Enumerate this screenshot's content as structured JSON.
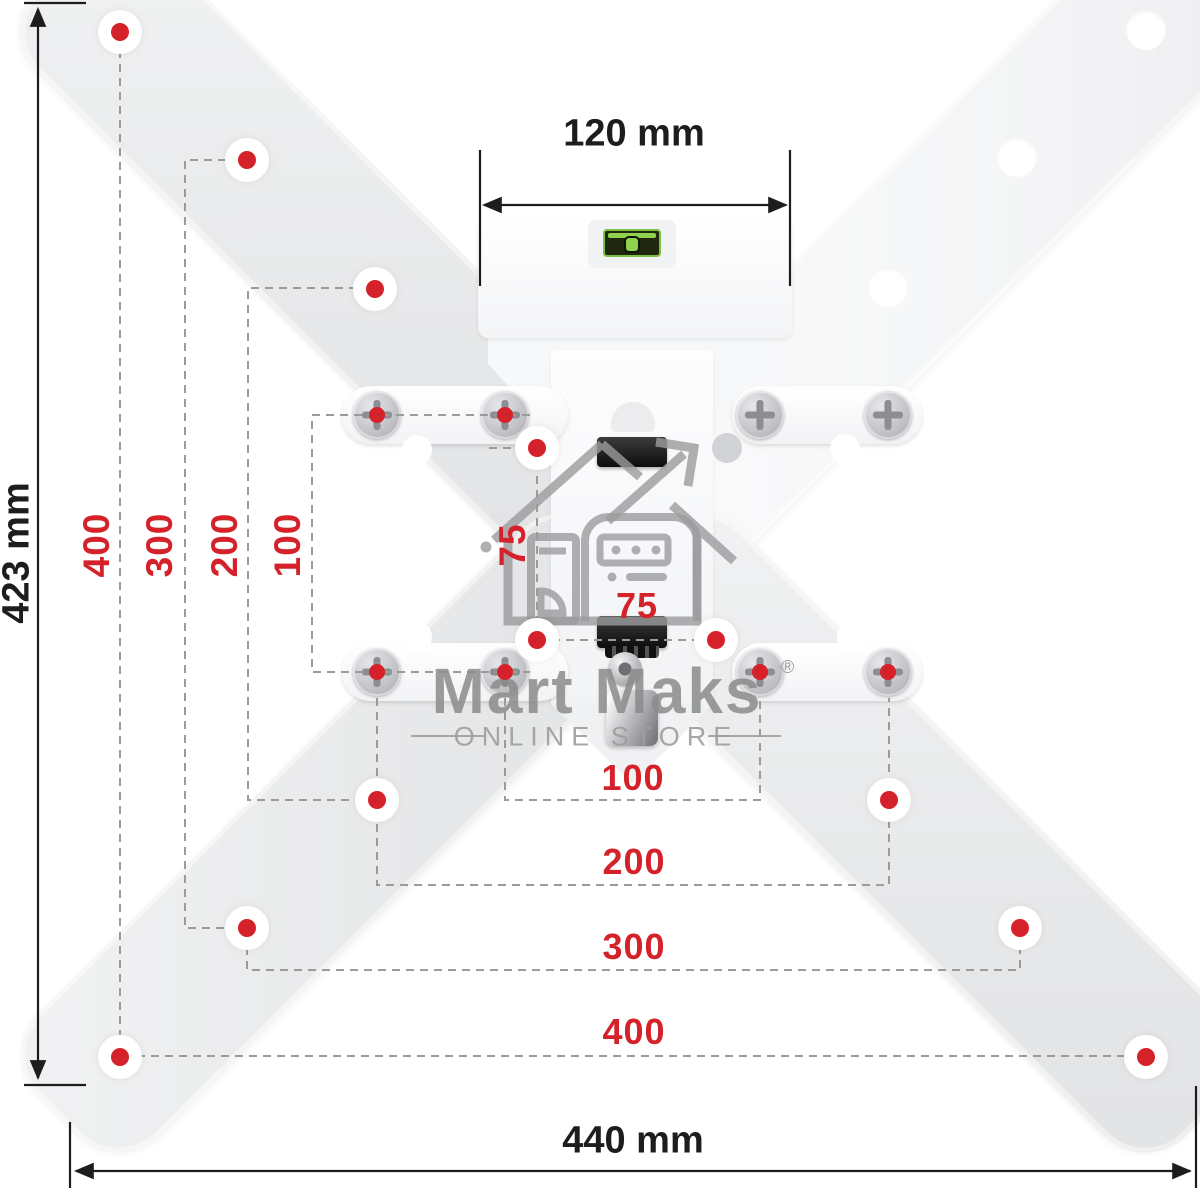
{
  "dimension_labels": {
    "top_width": "120 mm",
    "left_height": "423 mm",
    "bottom_width": "440 mm"
  },
  "vesa_vertical": [
    "400",
    "300",
    "200",
    "100",
    "75"
  ],
  "vesa_horizontal": [
    "75",
    "100",
    "200",
    "300",
    "400"
  ],
  "watermark": {
    "brand": "Mart Maks",
    "registered_mark": "®",
    "tagline": "ONLINE STORE"
  },
  "colors": {
    "accent-red": "#d5222a",
    "ink": "#1d1d1f",
    "dash-gray": "#9b9b9c",
    "watermark-gray": "#8b8b8b",
    "tagline-gray": "#9e9e9e",
    "icon-gray": "#9c9c9e",
    "level-green": "#7cc142",
    "arm-gray": "#e8e9ea",
    "arm-white": "#f5f6f7"
  }
}
